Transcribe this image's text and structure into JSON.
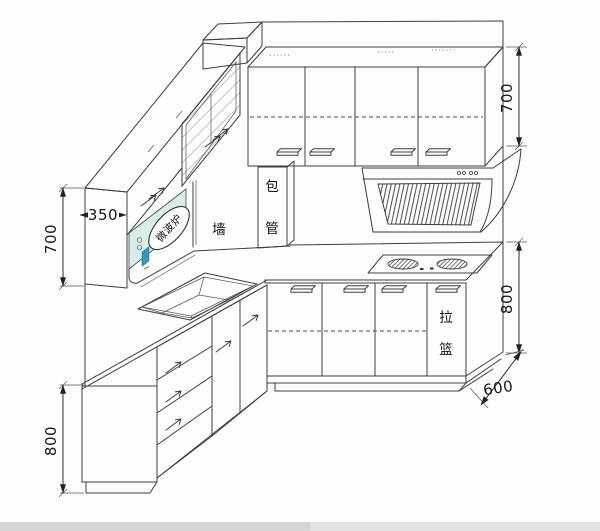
{
  "drawing": {
    "kind": "kitchen cabinet isometric CAD line drawing",
    "labels": {
      "wall": "墙",
      "pipe_box_top": "包",
      "pipe_box_bottom": "管",
      "pull_basket_top": "拉",
      "pull_basket_bottom": "篮",
      "microwave_callout": "微波炉"
    },
    "dimensions": {
      "left_wall_cabinet_height": "700",
      "left_wall_cabinet_depth": "350",
      "left_base_cabinet_height": "800",
      "right_wall_cabinet_height": "700",
      "right_base_cabinet_height": "800",
      "worktop_depth": "600"
    },
    "colors": {
      "line": "#3e3e3e",
      "microwave_fill": "#d8eee7",
      "display_fill": "#2f9cb0",
      "background": "#fdfdfc",
      "bottom_strip": "#e2e2e0",
      "bottom_strip_dark": "#d6d6d3"
    }
  }
}
